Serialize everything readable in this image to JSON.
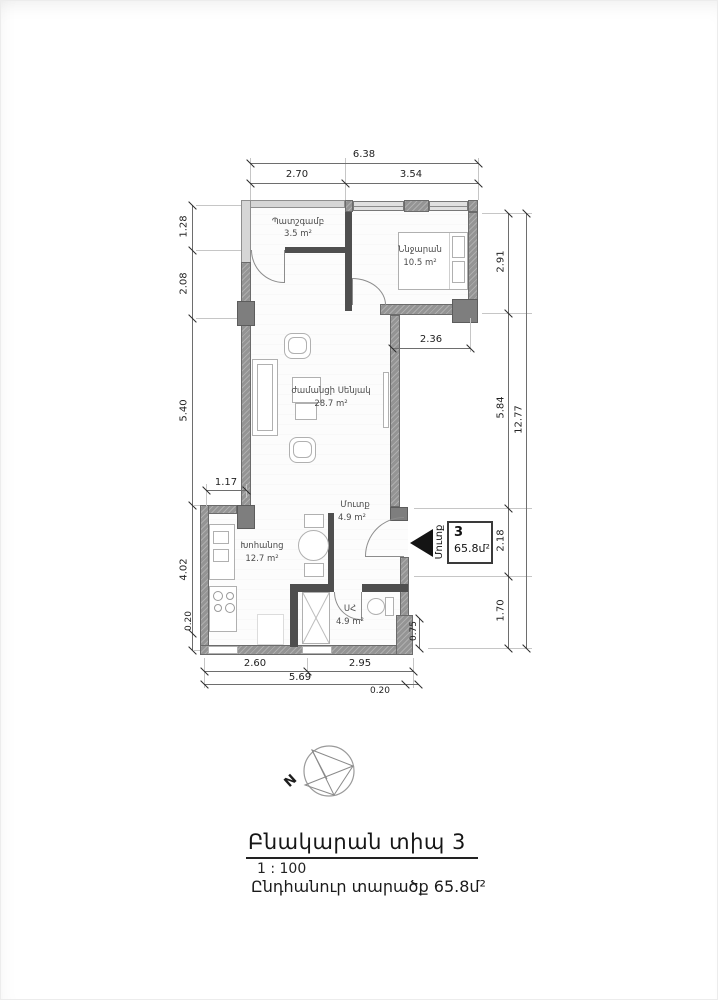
{
  "page": {
    "title": "Բնակարան տիպ 3",
    "scale": "1 : 100",
    "total_area_label": "Ընդհանուր տարածք 65.8մ²"
  },
  "compass": {
    "north_label": "N"
  },
  "entry_marker": {
    "direction_label": "Մուտք",
    "apartment_number": "3",
    "area": "65.8մ²"
  },
  "rooms": {
    "balcony": {
      "name": "Պատշգամբ",
      "area": "3.5 m²"
    },
    "bedroom": {
      "name": "Ննջարան",
      "area": "10.5 m²"
    },
    "living": {
      "name": "ժամանցի Սենյակ",
      "area": "28.7 m²"
    },
    "hall": {
      "name": "Մուտք",
      "area": "4.9 m²"
    },
    "kitchen": {
      "name": "Խոհանոց",
      "area": "12.7 m²"
    },
    "bath": {
      "name": "ՍՀ",
      "area": "4.9 m²"
    }
  },
  "dims": {
    "top_total": "6.38",
    "top_left": "2.70",
    "top_right": "3.54",
    "left_1": "1.28",
    "left_2": "2.08",
    "left_3": "5.40",
    "left_4": "4.02",
    "left_5": "0.20",
    "mid_117": "1.17",
    "mid_236": "2.36",
    "right_1": "2.91",
    "right_2": "5.84",
    "right_3": "2.18",
    "right_4": "1.70",
    "right_total": "12.77",
    "right_075": "0.75",
    "bottom_1": "2.60",
    "bottom_2": "2.95",
    "bottom_total": "5.69",
    "bottom_020": "0.20"
  }
}
